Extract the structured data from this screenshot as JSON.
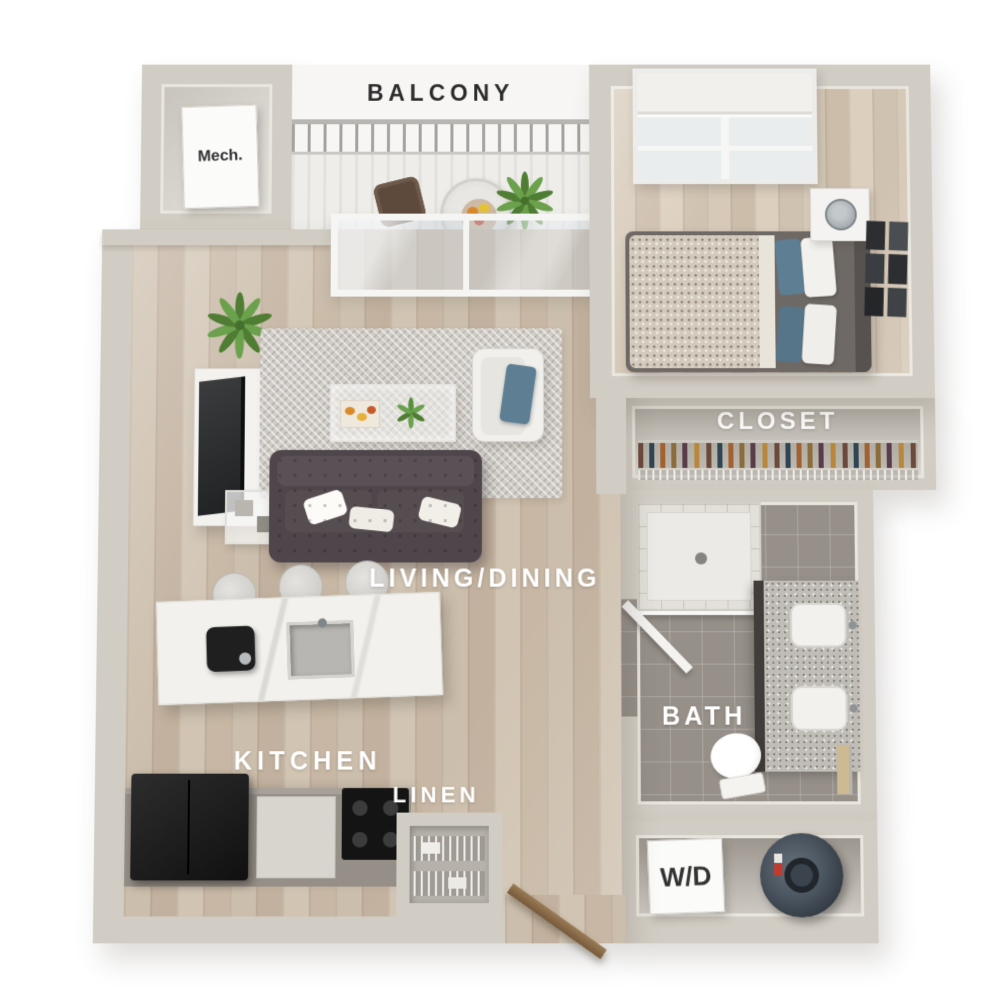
{
  "labels": {
    "balcony": "BALCONY",
    "mech": "Mech.",
    "living_dining": "LIVING/DINING",
    "kitchen": "KITCHEN",
    "linen": "LINEN",
    "closet": "CLOSET",
    "bath": "BATH",
    "washer_dryer": "W/D"
  },
  "colors": {
    "background": "#ffffff",
    "wall": "#d2cdc4",
    "wall_inner": "#e9e6df",
    "floor_wood": "#c9baa8",
    "floor_wood_bedroom": "#d2c5b3",
    "bath_tile": "#969089",
    "rug": "#d0ccc6",
    "sofa": "#4e464a",
    "accent_pillow_blue": "#5d7e93",
    "counter": "#958f87",
    "appliance_black": "#1d1c1c",
    "island_marble": "#f2f1ed",
    "plant_green": "#5d8c3e",
    "water_heater": "#46505a",
    "label_light": "#ffffff",
    "label_dark": "#2b2b2b"
  }
}
